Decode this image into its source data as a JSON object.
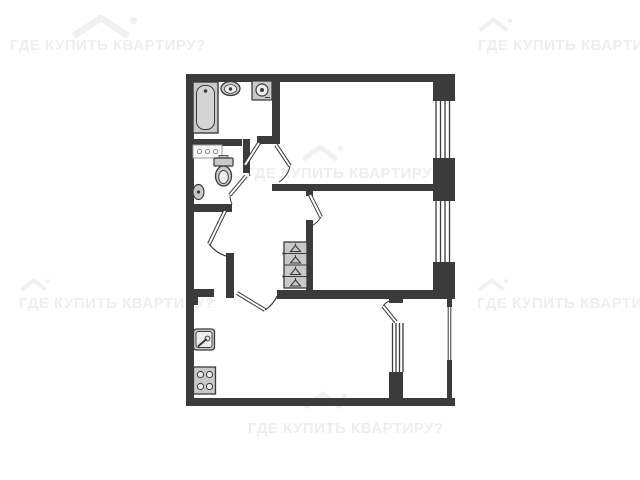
{
  "watermark": {
    "text": "ГДЕ КУПИТЬ КВАРТИРУ?",
    "color": "#eeeeee",
    "icon": "house-icon",
    "instances": 6
  },
  "floor_plan": {
    "type": "apartment-floor-plan",
    "background": "#ffffff",
    "wall_color": "#3b3b3b",
    "fixture_fill": "#c9c9c9",
    "rooms": [
      "bathroom",
      "wc",
      "hallway",
      "bedroom-top",
      "bedroom-middle",
      "kitchen-living-room",
      "balcony"
    ],
    "fixtures": [
      "bathtub",
      "bathroom-sink",
      "washing-machine",
      "vanity",
      "toilet",
      "wash-basin",
      "wardrobe",
      "kitchen-sink",
      "stove"
    ],
    "windows": 4,
    "door_leaves": 7
  }
}
